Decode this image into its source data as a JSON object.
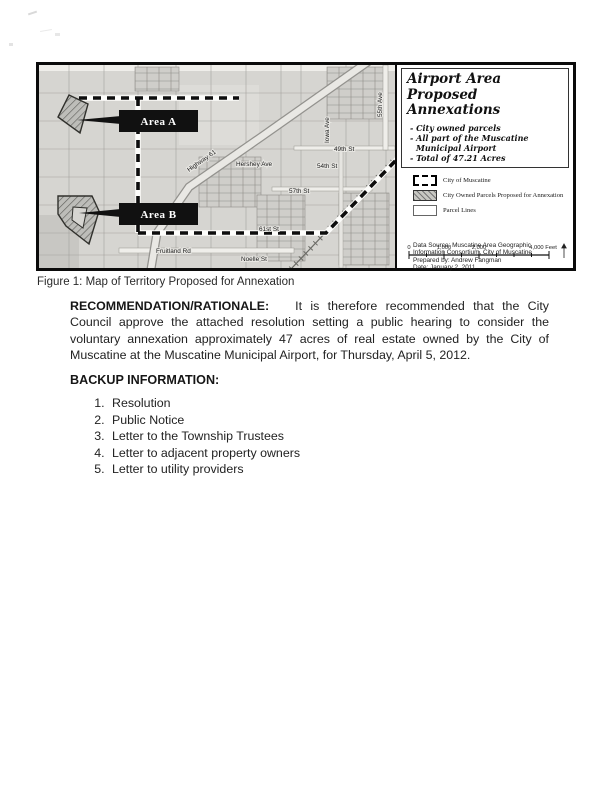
{
  "figure": {
    "caption": "Figure 1: Map of Territory Proposed for Annexation",
    "map": {
      "area_a": "Area A",
      "area_b": "Area B",
      "labels": {
        "highway": "Highway 61",
        "st49": "49th St",
        "st54": "54th St",
        "st57": "57th St",
        "st61": "61st St",
        "hershey": "Hershey Ave",
        "noelle": "Noelle St",
        "fruitland": "Fruitland Rd",
        "iowa": "Iowa Ave",
        "ave55": "55th Ave"
      }
    },
    "panel": {
      "title_line1": "Airport Area",
      "title_line2": "Proposed Annexations",
      "bullets": [
        "- City owned parcels",
        "- All part of the Muscatine Municipal Airport",
        "- Total of 47.21 Acres"
      ],
      "legend": [
        {
          "label": "City of Muscatine",
          "swatch": "dashed-city-boundary"
        },
        {
          "label": "City Owned Parcels Proposed for Annexation",
          "swatch": "gray-hatch"
        },
        {
          "label": "Parcel Lines",
          "swatch": "white-outline"
        }
      ],
      "credits": [
        "Data Source: Muscatine Area Geographic",
        "Information Consortium, City of Muscatine",
        "Prepared by: Andrew Fangman",
        "Date: January 2, 2011"
      ],
      "scale": {
        "labels": [
          "0",
          "1,000",
          "2,000",
          "4,000 Feet"
        ]
      }
    }
  },
  "recommendation": {
    "heading": "RECOMMENDATION/RATIONALE:",
    "body": "It is therefore recommended that the City Council approve the attached resolution setting a public hearing to consider the voluntary annexation approximately 47 acres of real estate owned by the City of Muscatine at the Muscatine Municipal Airport, for Thursday, April 5, 2012."
  },
  "backup": {
    "heading": "BACKUP INFORMATION:",
    "items": [
      "Resolution",
      "Public Notice",
      "Letter to the Township Trustees",
      "Letter to adjacent property owners",
      "Letter to utility providers"
    ]
  },
  "colors": {
    "map_background": "#d6d5d1",
    "parcel_line": "#a3a29d",
    "annexation_fill": "#bdbdb9",
    "boundary": "#0d0d0d",
    "label_box": "#111111"
  }
}
